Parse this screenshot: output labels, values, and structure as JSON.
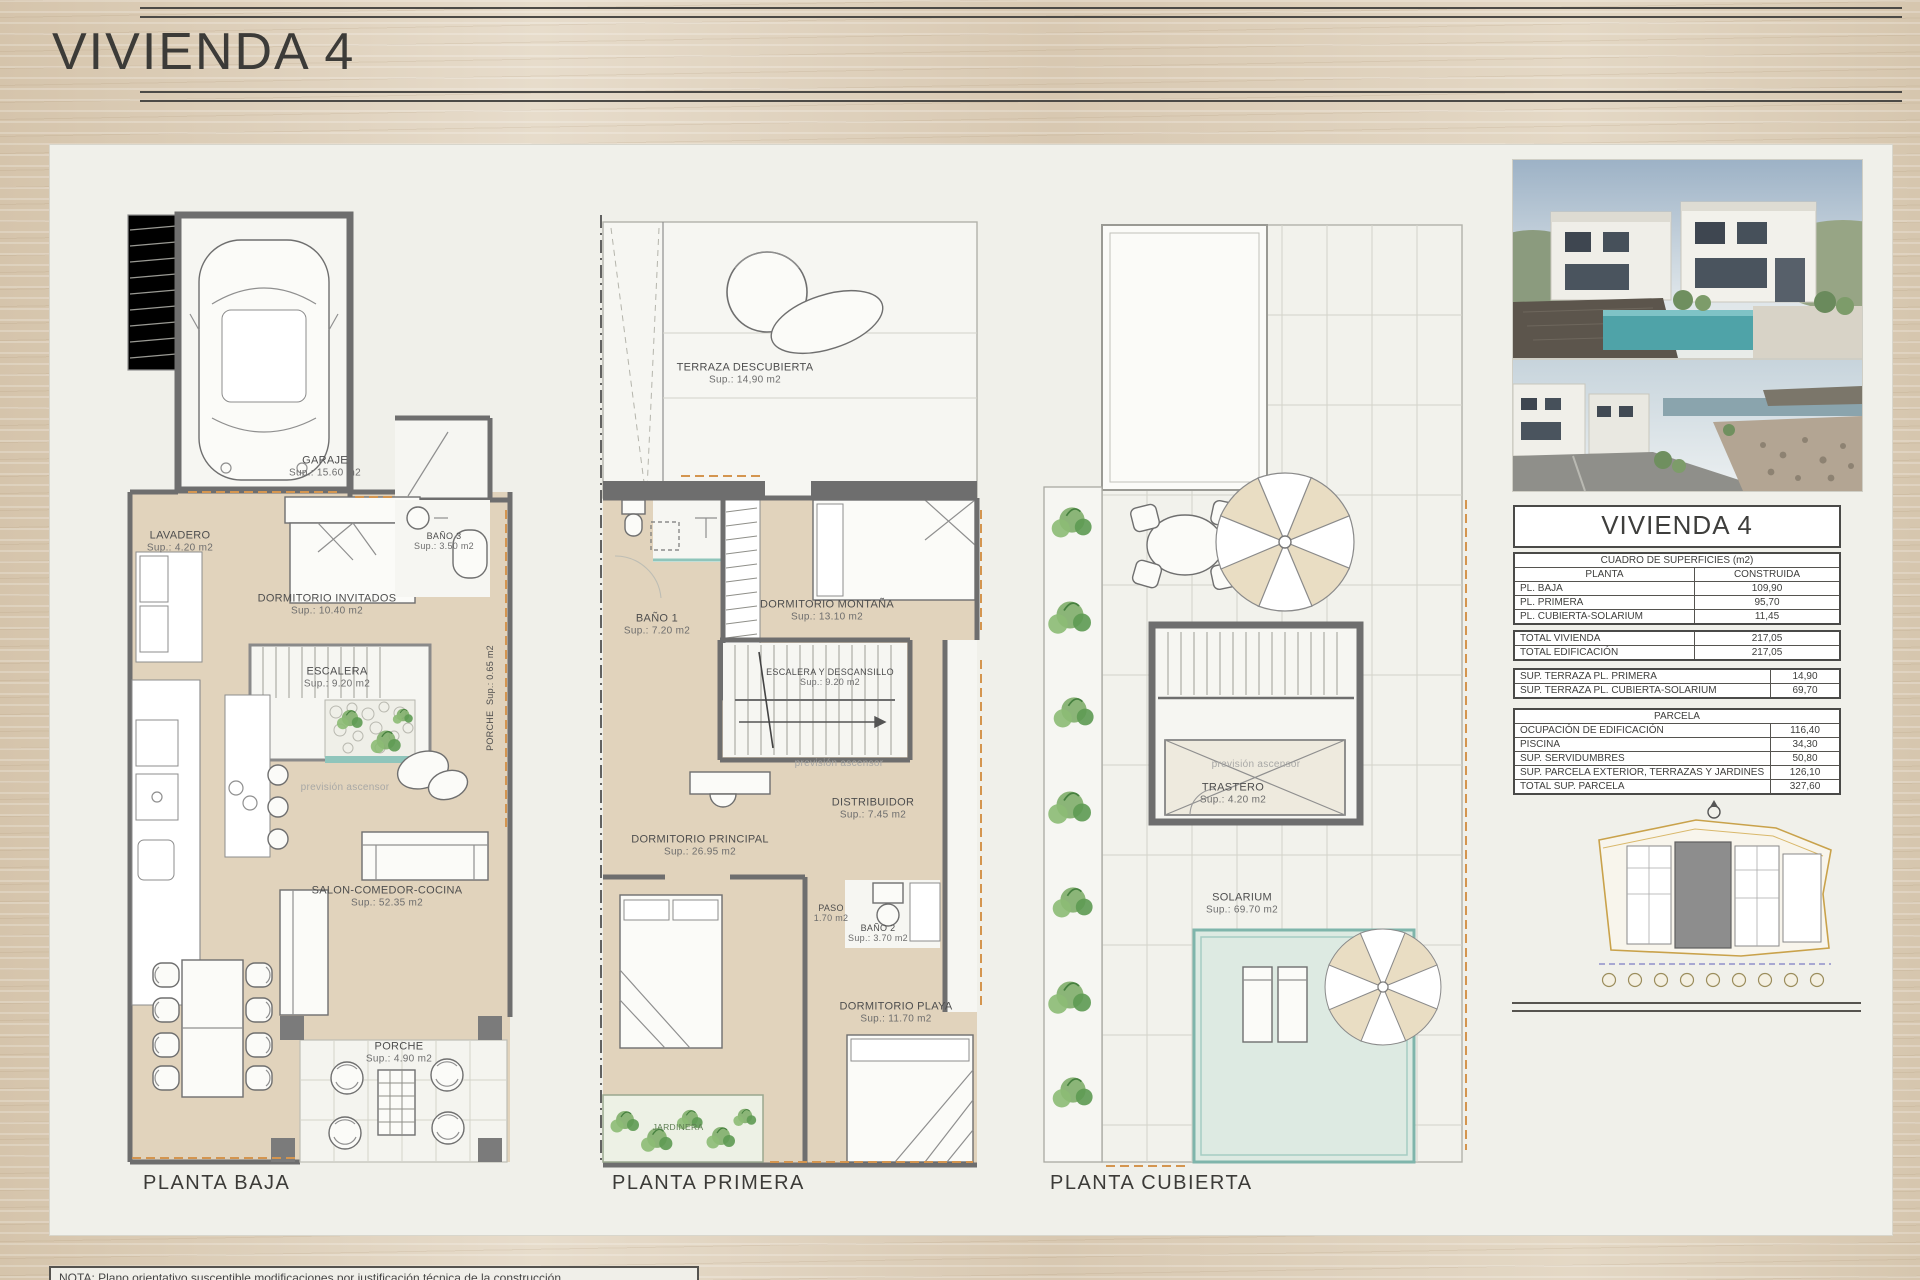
{
  "header": {
    "title": "VIVIENDA 4"
  },
  "misc": {
    "ascensor": "previsión ascensor"
  },
  "plans": {
    "baja": {
      "caption": "PLANTA BAJA",
      "rooms": [
        {
          "name": "GARAJE",
          "area": "Sup.: 15.60  m2"
        },
        {
          "name": "LAVADERO",
          "area": "Sup.: 4.20  m2"
        },
        {
          "name": "DORMITORIO INVITADOS",
          "area": "Sup.: 10.40  m2"
        },
        {
          "name": "BAÑO 3",
          "area": "Sup.: 3.50  m2"
        },
        {
          "name": "ESCALERA",
          "area": "Sup.: 9.20  m2"
        },
        {
          "name": "PORCHE",
          "area": "Sup.: 0.65  m2"
        },
        {
          "name": "SALON-COMEDOR-COCINA",
          "area": "Sup.: 52.35  m2"
        },
        {
          "name": "PORCHE",
          "area": "Sup.: 4.90  m2"
        }
      ]
    },
    "primera": {
      "caption": "PLANTA PRIMERA",
      "rooms": [
        {
          "name": "TERRAZA DESCUBIERTA",
          "area": "Sup.: 14,90  m2"
        },
        {
          "name": "BAÑO 1",
          "area": "Sup.: 7.20  m2"
        },
        {
          "name": "DORMITORIO MONTAÑA",
          "area": "Sup.: 13.10  m2"
        },
        {
          "name": "ESCALERA Y DESCANSILLO",
          "area": "Sup.: 9.20  m2"
        },
        {
          "name": "DISTRIBUIDOR",
          "area": "Sup.: 7.45  m2"
        },
        {
          "name": "DORMITORIO PRINCIPAL",
          "area": "Sup.: 26.95  m2"
        },
        {
          "name": "PASO",
          "area": "1.70 m2"
        },
        {
          "name": "BAÑO 2",
          "area": "Sup.: 3.70  m2"
        },
        {
          "name": "DORMITORIO PLAYA",
          "area": "Sup.: 11.70  m2"
        },
        {
          "name": "JARDINERA",
          "area": ""
        }
      ]
    },
    "cubierta": {
      "caption": "PLANTA CUBIERTA",
      "rooms": [
        {
          "name": "TRASTERO",
          "area": "Sup.: 4.20  m2"
        },
        {
          "name": "SOLARIUM",
          "area": "Sup.: 69.70  m2"
        }
      ]
    }
  },
  "surfaces": {
    "title": "VIVIENDA 4",
    "subtitle": "CUADRO DE SUPERFICIES (m2)",
    "columns": {
      "planta": "PLANTA",
      "construida": "CONSTRUIDA"
    },
    "floors": [
      {
        "label": "PL. BAJA",
        "value": "109,90"
      },
      {
        "label": "PL. PRIMERA",
        "value": "95,70"
      },
      {
        "label": "PL. CUBIERTA-SOLARIUM",
        "value": "11,45"
      }
    ],
    "totals": [
      {
        "label": "TOTAL VIVIENDA",
        "value": "217,05"
      },
      {
        "label": "TOTAL EDIFICACIÓN",
        "value": "217,05"
      }
    ],
    "terraces": [
      {
        "label": "SUP. TERRAZA PL. PRIMERA",
        "value": "14,90"
      },
      {
        "label": "SUP. TERRAZA PL. CUBIERTA-SOLARIUM",
        "value": "69,70"
      }
    ],
    "parcela": {
      "header": "PARCELA",
      "rows": [
        {
          "label": "OCUPACIÓN DE EDIFICACIÓN",
          "value": "116,40"
        },
        {
          "label": "PISCINA",
          "value": "34,30"
        },
        {
          "label": "SUP. SERVIDUMBRES",
          "value": "50,80"
        },
        {
          "label": "SUP. PARCELA EXTERIOR, TERRAZAS Y JARDINES",
          "value": "126,10"
        },
        {
          "label": "TOTAL SUP. PARCELA",
          "value": "327,60"
        }
      ]
    }
  },
  "note": "NOTA: Plano orientativo susceptible modificaciones por justificación técnica de la construcción."
}
